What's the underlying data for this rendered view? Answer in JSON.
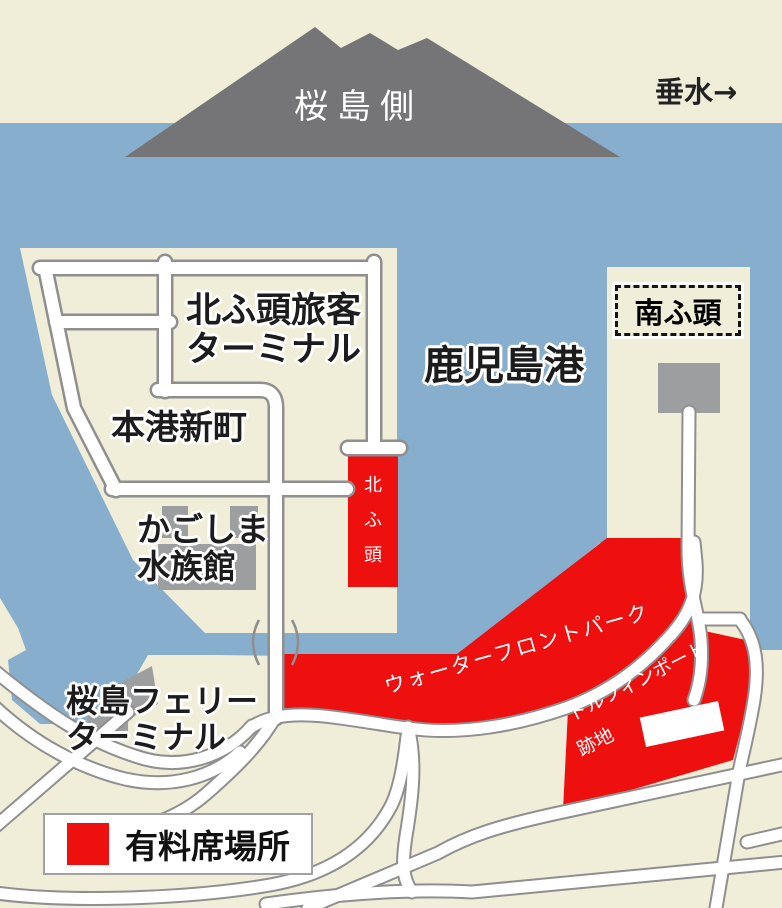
{
  "map": {
    "region_labels": {
      "sakurajima": "桜島側",
      "tarumizu": "垂水→",
      "bay": "鹿児島港",
      "north_pier_terminal": [
        "北ふ頭旅客",
        "ターミナル"
      ],
      "honko_shinmachi": "本港新町",
      "aquarium": [
        "かごしま",
        "水族館"
      ],
      "north_pier_vertical": [
        "北",
        "ふ",
        "頭"
      ],
      "south_pier": "南ふ頭",
      "sakurajima_ferry_terminal": [
        "桜島フェリー",
        "ターミナル"
      ],
      "waterfront_park": "ウォーターフロントパーク",
      "dolphin_port": [
        "ドルフィンポート",
        "跡地"
      ]
    },
    "legend": {
      "label": "有料席場所",
      "swatch_color": "#ee0f0f"
    },
    "colors": {
      "sea": "#88aecd",
      "land": "#f0eed9",
      "mountain": "#757578",
      "paid": "#ee0f0f",
      "building": "#9c9ea0",
      "casing": "#8f8f8f"
    }
  }
}
